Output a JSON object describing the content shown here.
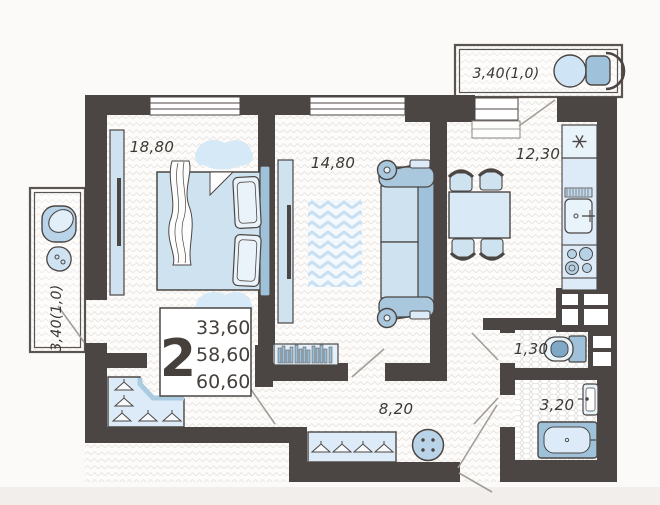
{
  "plan": {
    "type": "apartment-floor-plan",
    "rooms": {
      "bedroom": {
        "name": "bedroom",
        "area": "18,80"
      },
      "living_room": {
        "name": "living room",
        "area": "14,80"
      },
      "kitchen": {
        "name": "kitchen",
        "area": "12,30"
      },
      "hallway": {
        "name": "hallway",
        "area": "8,20"
      },
      "toilet": {
        "name": "toilet",
        "area": "1,30"
      },
      "bathroom": {
        "name": "bathroom",
        "area": "3,20"
      },
      "balcony_left": {
        "name": "left balcony",
        "area": "3,40(1,0)"
      },
      "balcony_top": {
        "name": "top balcony",
        "area": "3,40(1,0)"
      }
    },
    "summary": {
      "rooms_count": "2",
      "living_area": "33,60",
      "area_no_balcony": "58,60",
      "total_area": "60,60"
    },
    "icons": {
      "fridge_indicator": "snowflake-asterisk",
      "hanger": "clothes-hanger",
      "stove": "four-burners",
      "pouf": "round-pouf-4-dots"
    },
    "colors": {
      "wall": "#4b4643",
      "furniture_light": "#dcebf7",
      "furniture_lighter": "#e9f3fa",
      "furniture_mid": "#b9d4e8",
      "furniture_deep": "#9fc2da",
      "door_line": "#a39d98",
      "label_text": "#3a3633",
      "floor_bg": "#fdfcfa",
      "hatch_line": "#e8e5e1",
      "rug_blue": "#d6e9f7"
    }
  }
}
